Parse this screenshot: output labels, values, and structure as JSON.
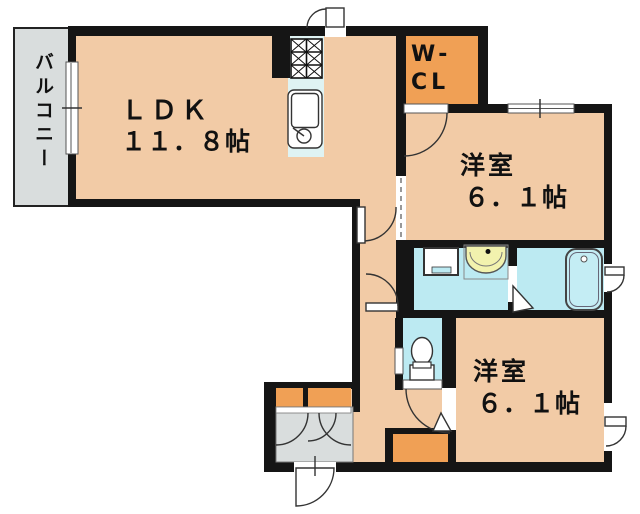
{
  "floorplan": {
    "title": "apartment floor plan",
    "rooms": {
      "balcony": {
        "label": "バルコニー"
      },
      "ldk": {
        "label": "ＬＤＫ",
        "size": "１１．８帖"
      },
      "wcl": {
        "label_line1": "W-",
        "label_line2": "CL"
      },
      "bedroom_top": {
        "label": "洋室",
        "size": "６．１帖"
      },
      "bedroom_bottom": {
        "label": "洋室",
        "size": "６．１帖"
      }
    },
    "fixtures": [
      "gas-stove",
      "kitchen-sink",
      "washing-machine-pan",
      "washbasin",
      "bathtub",
      "toilet",
      "shoe-cabinets",
      "entrance-door",
      "closet-box"
    ],
    "colors": {
      "room_pink": "#f2cba6",
      "closet_orange": "#f0a055",
      "wet_area_cyan": "#bceaf2",
      "kitchen_counter": "#dff3f3",
      "balcony_gray": "#d9dddd",
      "wall_black": "#151515",
      "basin_cream": "#f2f2ae"
    }
  }
}
